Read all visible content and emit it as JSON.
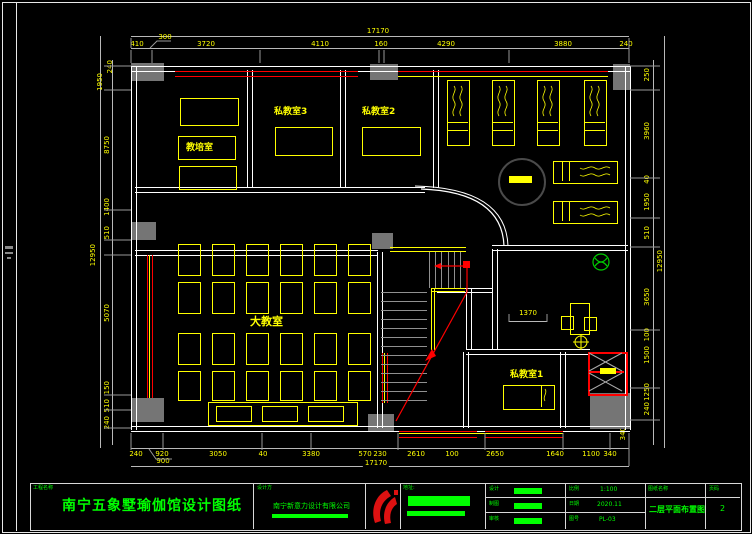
{
  "dims": {
    "top": [
      "410",
      "300",
      "3720",
      "4110",
      "160",
      "4290",
      "3880",
      "240"
    ],
    "top_overall": "17170",
    "bottom": [
      "240",
      "920",
      "3050",
      "40",
      "3380",
      "570",
      "230",
      "2610",
      "100",
      "2650",
      "1640",
      "1100",
      "340"
    ],
    "bottom_overall": "17170",
    "bottom_leader": "900",
    "left": [
      "240",
      "1950",
      "8750",
      "1400",
      "510",
      "5070",
      "150",
      "510",
      "240"
    ],
    "left_overall": "12950",
    "right": [
      "250",
      "3960",
      "40",
      "1950",
      "510",
      "3650",
      "100",
      "1500",
      "1250",
      "240",
      "340"
    ],
    "right_overall": "12950",
    "inner": "1370"
  },
  "rooms": {
    "training_room": "教培室",
    "private_room_3": "私教室3",
    "private_room_2": "私教室2",
    "big_classroom": "大教室",
    "private_room_1": "私教室1"
  },
  "titleblock": {
    "project_label": "工程名称",
    "project_name": "南宁五象墅瑜伽馆设计图纸",
    "designer_label": "设计方",
    "designer_name": "南宁新意力设计有限公司",
    "address_label": "地址:",
    "rows_left": [
      {
        "label": "设计"
      },
      {
        "label": "制图"
      },
      {
        "label": "审核"
      }
    ],
    "rows_right": [
      {
        "label": "比例",
        "value": "1:100"
      },
      {
        "label": "日期",
        "value": "2020.11"
      },
      {
        "label": "图号",
        "value": "PL-03"
      }
    ],
    "sheet_label": "图纸名称",
    "sheet_name": "二层平面布置图",
    "page_label": "页码",
    "page_value": "2"
  },
  "colors": {
    "wall_line": "#ffffff",
    "furniture": "#ffff00",
    "dimension": "#ffff00",
    "annotation": "#00ff00",
    "hatch": "#ff0000",
    "column_fill": "#777777"
  }
}
